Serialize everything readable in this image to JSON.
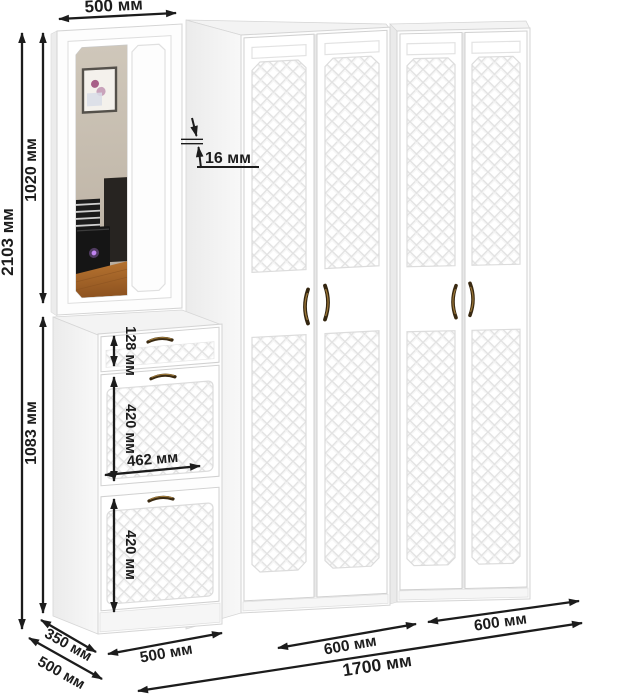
{
  "diagram": {
    "description": "Hallway furniture set dimension drawing: mirror cabinet, shoe cabinet and two wardrobes",
    "units": "мм"
  },
  "dimensions": {
    "cabinet_width": "500 мм",
    "total_height": "2103 мм",
    "upper_cabinet_height": "1020 мм",
    "lower_cabinet_height": "1083 мм",
    "panel_thickness": "16 мм",
    "drawer_height": "128 мм",
    "upper_flap_height": "420 мм",
    "flap_width": "462 мм",
    "lower_flap_height": "420 мм",
    "shoe_cabinet_depth": "350 мм",
    "shoe_cabinet_width": "500 мм",
    "wardrobe_depth": "500 мм",
    "wardrobe1_width": "600 мм",
    "wardrobe2_width": "600 мм",
    "total_width": "1700 мм"
  },
  "colors": {
    "background": "#ffffff",
    "furniture_front": "#fdfdfd",
    "side_shade": "#efefef",
    "top_shade": "#f3f3f3",
    "outline": "#d4d4d4",
    "pattern_line": "#e2e2e2",
    "dimension_ink": "#1c1c1c",
    "handle_bronze": "#3a2a12",
    "handle_glint": "#9b7637",
    "mirror_wall": "#c8bfb2",
    "mirror_floor": "#a9662c"
  }
}
